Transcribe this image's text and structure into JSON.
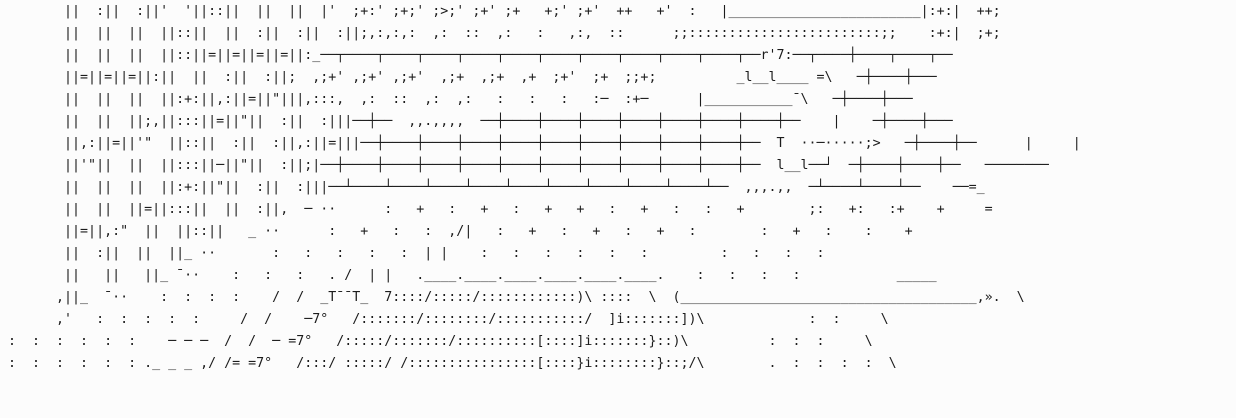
{
  "meta": {
    "title": "ascii-art-scene",
    "description": "Monochrome ASCII text art: vertical double-bar girders on the left, a long cross-hatch lattice fence across the upper area with a small roof shape and box structure at its right, a dotted field, a signal pole with ladder diagonals, and a hatched staircase with a long handrail line trailing to a diagonal at the lower right.",
    "background_color": "#fcfcfc",
    "ink_color": "#1c1c1c"
  },
  "art": {
    "lines": [
      "        ||  :||  :||'  '||::||  ||  ||  |'  ;+:' ;+;' ;>;' ;+' ;+   +;' ;+'  ++   +'  :   |________________________|:+:|  ++;",
      "        ||  ||  ||  ||::||  ||  :||  :||  :||;,:,:,:  ,:  ::  ,:   :   ,:,  ::      ;;::::::::::::::::::::::::;;    :+:|  ;+;",
      "        ||  ||  ||  ||::||=||=||=||=||:_──┬────┬────┬────┬────┬────┬────┬────┬────┬────┬────┬──r'7:──┬────┼────┬────┬──",
      "        ||=||=||=||:||  ||  :||  :||;  ,;+' ,;+' ,;+'  ,;+  ,;+  ,+  ;+'  ;+  ;;+;          _l__l____ =\\   ─┼────┼───",
      "        ||  ||  ||  ||:+:||,:||=||\"|||,:::,  ,:  ::  ,:  ,:   :   :   :   :─  :+─      |___________¯\\   ─┼────┼───",
      "        ||  ||  ||;,||:::||=||\"||  :||  :|||──┼──  ,,.,,,,  ──┼────┼────┼────┼────┼────┼────┼────┼──    |    ─┼────┼───",
      "        ||,:||=||'\"  ||::||  :||  :||,:||=|||──┼────┼────┼────┼────┼────┼────┼────┼────┼────┼──  T  ··─·····;>   ─┼────┼──      |     |",
      "        ||'\"||  ||  ||:::||─||\"||  :||;|──┼────┼────┼────┼────┼────┼────┼────┼────┼────┼────┼──  l__l──┘  ─┼────┼────┼──   ────────",
      "        ||  ||  ||  ||:+:||\"||  :||  :|||──┴────┴────┴────┴────┴────┴────┴────┴────┴────┴──  ,,,.,,  ─┴────┴────┴──    ──=_",
      "        ||  ||  ||=||:::||  ||  :||,  ─ ··      :   +   :   +   :   +   +   :   +   :   :   +        ;:   +:   :+    +     =",
      "        ||=||,:\"  ||  ||::||   _ ··      :   +   :   :  ,/|   :   +   :   +   :   +   :        :   +   :    :    +",
      "        ||  :||  ||  ||_ ··       :   :   :   :   :  | |    :   :   :   :   :   :         :   :   :   :",
      "        ||   ||   ||_ ¯··    :   :   :   . /  | |   .____.____.____.____.____.____.    :   :   :   :            _____",
      "       ,||_  ¯··    :  :  :  :    /  /  _T¯¯T_  7::::/:::::/::::::::::::)\\ ::::  \\  (_____________________________________,».  \\",
      "       ,'   :  :  :  :  :     /  /    ─7°   /:::::::/::::::::/:::::::::::/  ]i:::::::])\\             :  :     \\",
      " :  :  :  :  :  :    ─ ─ ─  /  /  ─ =7°   /:::::/:::::::/::::::::::[::::]i:::::::}::)\\          :  :  :     \\",
      " :  :  :  :  :  : ._ _ _ ,/ /= =7°   /:::/ :::::/ /::::::::::::::::[::::}i::::::::}::;/\\        .  :  :  :  :  \\"
    ]
  }
}
